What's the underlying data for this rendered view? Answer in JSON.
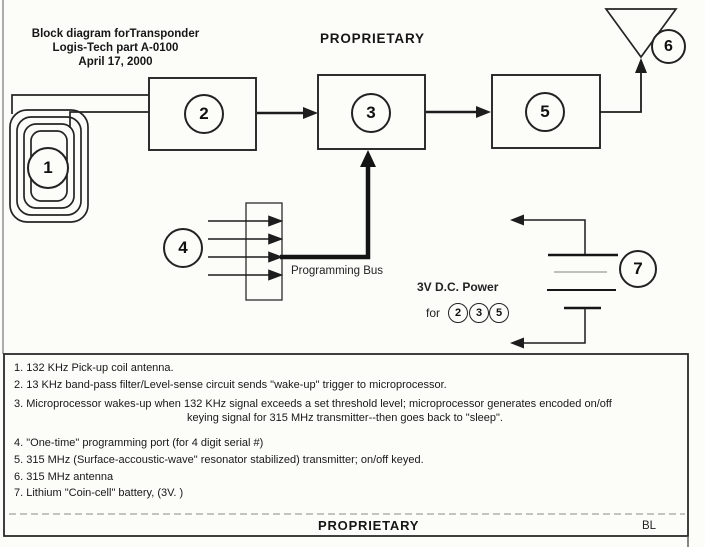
{
  "header": {
    "title_line1": "Block diagram forTransponder",
    "title_line2": "Logis-Tech part A-0100",
    "title_line3": "April 17, 2000",
    "proprietary": "PROPRIETARY"
  },
  "diagram": {
    "block_numbers": {
      "coil": "1",
      "filter": "2",
      "micro": "3",
      "port": "4",
      "transmitter": "5",
      "antenna": "6",
      "battery": "7"
    },
    "programming_bus_label": "Programming Bus",
    "power_label": "3V D.C. Power",
    "power_for": "for",
    "power_targets": [
      "2",
      "3",
      "5"
    ]
  },
  "legend": {
    "items": [
      "1.  132 KHz Pick-up coil antenna.",
      "2.  13 KHz band-pass filter/Level-sense circuit sends \"wake-up\" trigger to microprocessor.",
      "3.  Microprocessor wakes-up when 132 KHz signal exceeds a set threshold level; microprocessor generates encoded on/off",
      "keying signal for 315 MHz transmitter--then goes back to \"sleep\".",
      "4.  \"One-time\" programming port (for 4 digit serial #)",
      "5.  315 MHz (Surface-accoustic-wave\" resonator stabilized) transmitter; on/off keyed.",
      "6.  315 MHz antenna",
      "7.  Lithium \"Coin-cell\" battery, (3V. )"
    ]
  },
  "footer": {
    "proprietary": "PROPRIETARY",
    "initials": "BL"
  }
}
